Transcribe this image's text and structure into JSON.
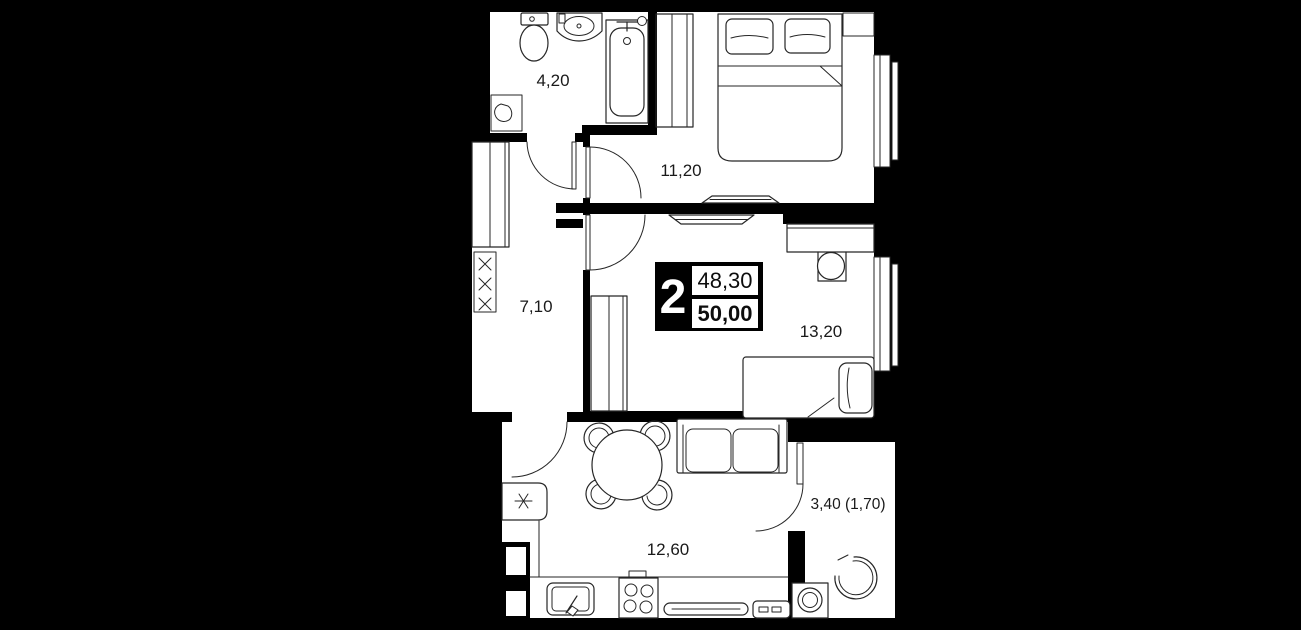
{
  "plan": {
    "background_color": "#000000",
    "floor_color": "#ffffff",
    "line_color": "#262626",
    "rooms": [
      {
        "id": "bathroom",
        "area_label": "4,20"
      },
      {
        "id": "bedroom",
        "area_label": "11,20"
      },
      {
        "id": "hallway",
        "area_label": "7,10"
      },
      {
        "id": "bedroom-2",
        "area_label": "13,20"
      },
      {
        "id": "kitchen-living",
        "area_label": "12,60"
      },
      {
        "id": "balcony",
        "area_label": "3,40 (1,70)"
      }
    ],
    "info_box": {
      "rooms_count": "2",
      "living_area": "48,30",
      "total_area": "50,00"
    }
  }
}
